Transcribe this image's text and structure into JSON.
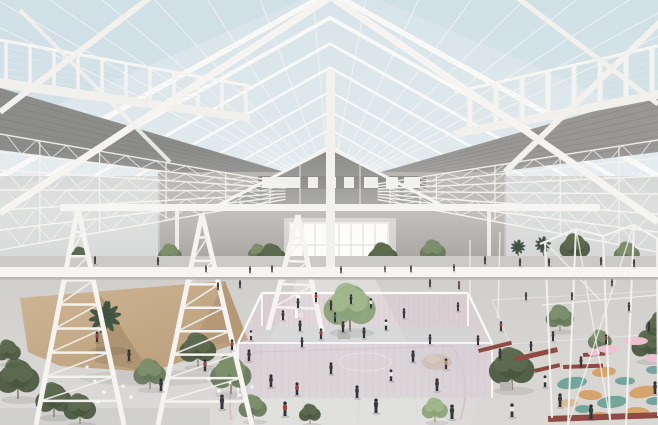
{
  "meta": {
    "kind": "architectural-interior-rendering",
    "visible_text": "none"
  },
  "palette": {
    "sky_top": "#d7e4e9",
    "sky_bottom": "#e9eff1",
    "sky_tint": "#cadde4",
    "structure": "#f4f3f0",
    "structure_dim": "#e2e0db",
    "wire": "#e8e7e4",
    "band_left": "#8c8c8a",
    "band_right": "#989795",
    "band_rib": "#6f6f6d",
    "gable_dark": "#8a8a88",
    "clerestory_dark": "#7d7c7a",
    "clerestory_glass": "#f2f3f1",
    "wall": "#aba7a3",
    "wall_dark": "#9c9894",
    "window_halo": "#cfccc7",
    "window_frame": "#e9e7e2",
    "window_glow": "#fcfbf8",
    "mullion": "#dddbd6",
    "mezz_floor": "#cbcac7",
    "rail": "#f6f5f2",
    "rail_shadow": "#b9b7b3",
    "floor_top": "#cfcecb",
    "floor_bottom": "#dcdbd9",
    "floor_bright": "#e4e3e1",
    "floor_warm": "#d7d5d1",
    "court_pink": "#dfaecb",
    "court_pink_line": "#d2a2bd",
    "court_floor": "#d2d3d5",
    "canopy": "#c8ae8d",
    "canopy_shade": "#ab9270",
    "canopy_shade2": "#b49875",
    "mound": "#c2a888",
    "bench_red": "#8f4a43",
    "table_pink": "#ecc2d3",
    "patch_teal": "#68a096",
    "patch_orange": "#d59f62",
    "patch_tan": "#d9b98e",
    "tree_dark": "#49573f",
    "tree_dark_hi": "#5d6c50",
    "tree_mid": "#66785a",
    "tree_mid_hi": "#7d8f6c",
    "tree_light": "#8ba277",
    "tree_light_hi": "#a2b78d",
    "palm": "#3f5140",
    "palm_hi": "#4e6350",
    "trunk": "#8a7f6f",
    "pot": "#b8b6b2",
    "person_dark": "#3b3b40",
    "person_red": "#9e4341",
    "person_white": "#e7e6e3",
    "person_blue": "#4a617b",
    "person_tan": "#b29577",
    "head": "#2f3034",
    "legs": "#33343a",
    "light_dot": "#fdfdfb",
    "shadow": "#2a2a2a"
  },
  "scene": {
    "people": [
      [
        206,
        272,
        7,
        "d"
      ],
      [
        250,
        273,
        7,
        "d"
      ],
      [
        272,
        272,
        7,
        "d"
      ],
      [
        341,
        273,
        7,
        "d"
      ],
      [
        385,
        272,
        6,
        "d"
      ],
      [
        411,
        272,
        7,
        "d"
      ],
      [
        454,
        271,
        7,
        "d"
      ],
      [
        95,
        264,
        8,
        "d"
      ],
      [
        158,
        265,
        8,
        "d"
      ],
      [
        485,
        264,
        8,
        "d"
      ],
      [
        520,
        266,
        8,
        "d"
      ],
      [
        549,
        266,
        8,
        "d"
      ],
      [
        601,
        265,
        8,
        "d"
      ],
      [
        634,
        267,
        8,
        "d"
      ],
      [
        218,
        290,
        8,
        "d"
      ],
      [
        240,
        288,
        8,
        "d"
      ],
      [
        430,
        287,
        8,
        "d"
      ],
      [
        459,
        289,
        8,
        "r"
      ],
      [
        298,
        308,
        10,
        "d"
      ],
      [
        316,
        302,
        10,
        "r"
      ],
      [
        331,
        310,
        10,
        "d"
      ],
      [
        351,
        304,
        10,
        "d"
      ],
      [
        371,
        308,
        10,
        "w"
      ],
      [
        300,
        331,
        11,
        "d"
      ],
      [
        321,
        339,
        11,
        "r"
      ],
      [
        343,
        332,
        11,
        "d"
      ],
      [
        364,
        338,
        11,
        "d"
      ],
      [
        386,
        330,
        11,
        "w"
      ],
      [
        283,
        320,
        10,
        "d"
      ],
      [
        404,
        318,
        10,
        "d"
      ],
      [
        335,
        322,
        10,
        "b"
      ],
      [
        249,
        361,
        12,
        "d"
      ],
      [
        271,
        387,
        13,
        "d"
      ],
      [
        297,
        395,
        13,
        "r"
      ],
      [
        331,
        374,
        12,
        "d"
      ],
      [
        357,
        398,
        13,
        "d"
      ],
      [
        391,
        381,
        12,
        "w"
      ],
      [
        413,
        362,
        12,
        "d"
      ],
      [
        437,
        391,
        13,
        "d"
      ],
      [
        232,
        350,
        11,
        "r"
      ],
      [
        222,
        409,
        15,
        "d"
      ],
      [
        285,
        416,
        15,
        "r"
      ],
      [
        376,
        413,
        15,
        "d"
      ],
      [
        452,
        419,
        15,
        "d"
      ],
      [
        512,
        417,
        14,
        "w"
      ],
      [
        560,
        407,
        14,
        "d"
      ],
      [
        591,
        419,
        15,
        "d"
      ],
      [
        97,
        342,
        11,
        "r"
      ],
      [
        129,
        361,
        12,
        "d"
      ],
      [
        161,
        391,
        13,
        "d"
      ],
      [
        205,
        371,
        12,
        "r"
      ],
      [
        251,
        340,
        10,
        "w"
      ],
      [
        302,
        347,
        10,
        "d"
      ],
      [
        458,
        311,
        9,
        "d"
      ],
      [
        478,
        345,
        10,
        "d"
      ],
      [
        501,
        331,
        10,
        "r"
      ],
      [
        526,
        300,
        8,
        "d"
      ],
      [
        553,
        341,
        10,
        "d"
      ],
      [
        581,
        367,
        11,
        "d"
      ],
      [
        606,
        344,
        10,
        "r"
      ],
      [
        629,
        311,
        9,
        "d"
      ],
      [
        649,
        331,
        9,
        "d"
      ],
      [
        655,
        394,
        13,
        "d"
      ],
      [
        545,
        387,
        12,
        "w"
      ],
      [
        430,
        344,
        10,
        "d"
      ],
      [
        446,
        369,
        11,
        "t"
      ],
      [
        500,
        359,
        11,
        "d"
      ],
      [
        531,
        351,
        10,
        "d"
      ],
      [
        572,
        300,
        8,
        "d"
      ],
      [
        612,
        286,
        7,
        "d"
      ]
    ],
    "trees": [
      [
        107,
        350,
        22,
        "palm"
      ],
      [
        150,
        389,
        15,
        "m"
      ],
      [
        198,
        367,
        17,
        "d"
      ],
      [
        231,
        394,
        19,
        "m"
      ],
      [
        350,
        332,
        24,
        "l"
      ],
      [
        512,
        390,
        21,
        "d"
      ],
      [
        560,
        331,
        13,
        "m"
      ],
      [
        600,
        352,
        11,
        "m"
      ],
      [
        648,
        361,
        15,
        "d"
      ],
      [
        18,
        399,
        20,
        "d"
      ],
      [
        54,
        417,
        17,
        "d"
      ],
      [
        8,
        364,
        12,
        "d"
      ],
      [
        80,
        424,
        15,
        "d"
      ],
      [
        253,
        421,
        13,
        "m"
      ],
      [
        310,
        424,
        10,
        "d"
      ],
      [
        435,
        422,
        12,
        "l"
      ],
      [
        661,
        340,
        14,
        "d"
      ]
    ],
    "upper_trees": [
      [
        80,
        265,
        9,
        "d"
      ],
      [
        170,
        266,
        11,
        "m"
      ],
      [
        258,
        262,
        9,
        "m"
      ],
      [
        272,
        272,
        14,
        "d"
      ],
      [
        383,
        271,
        14,
        "d"
      ],
      [
        433,
        264,
        12,
        "m"
      ],
      [
        520,
        262,
        10,
        "palm"
      ],
      [
        545,
        261,
        11,
        "palm"
      ],
      [
        575,
        262,
        14,
        "d"
      ],
      [
        627,
        266,
        12,
        "m"
      ]
    ],
    "patches": [
      [
        572,
        383,
        15,
        6,
        -8,
        "teal"
      ],
      [
        604,
        372,
        12,
        5,
        -5,
        "orange"
      ],
      [
        625,
        381,
        10,
        4,
        0,
        "teal"
      ],
      [
        643,
        392,
        14,
        6,
        -10,
        "orange"
      ],
      [
        590,
        395,
        12,
        5,
        4,
        "orange"
      ],
      [
        612,
        402,
        15,
        6,
        -6,
        "teal"
      ],
      [
        637,
        412,
        12,
        5,
        0,
        "orange"
      ],
      [
        569,
        403,
        9,
        4,
        0,
        "tan"
      ],
      [
        654,
        370,
        8,
        4,
        0,
        "teal"
      ],
      [
        600,
        416,
        10,
        4,
        0,
        "orange"
      ],
      [
        655,
        401,
        9,
        4,
        -4,
        "teal"
      ],
      [
        583,
        409,
        8,
        4,
        0,
        "teal"
      ]
    ],
    "benches": [
      [
        478,
        349,
        34,
        4,
        -14
      ],
      [
        514,
        357,
        44,
        5,
        -13
      ],
      [
        534,
        369,
        26,
        4,
        -13
      ],
      [
        563,
        365,
        40,
        4,
        -2
      ],
      [
        583,
        353,
        22,
        4,
        -4
      ],
      [
        548,
        416,
        112,
        6,
        -2
      ]
    ],
    "tables": [
      [
        608,
        349,
        10,
        4
      ],
      [
        636,
        341,
        12,
        4
      ],
      [
        653,
        358,
        8,
        4
      ],
      [
        594,
        353,
        6,
        3
      ]
    ],
    "pots": [
      [
        344,
        330
      ],
      [
        506,
        382
      ]
    ],
    "lights": [
      [
        87,
        367
      ],
      [
        95,
        381
      ],
      [
        104,
        392
      ],
      [
        114,
        373
      ],
      [
        123,
        386
      ],
      [
        131,
        397
      ],
      [
        98,
        402
      ],
      [
        209,
        379
      ],
      [
        219,
        391
      ],
      [
        230,
        383
      ],
      [
        240,
        395
      ],
      [
        252,
        387
      ]
    ]
  }
}
